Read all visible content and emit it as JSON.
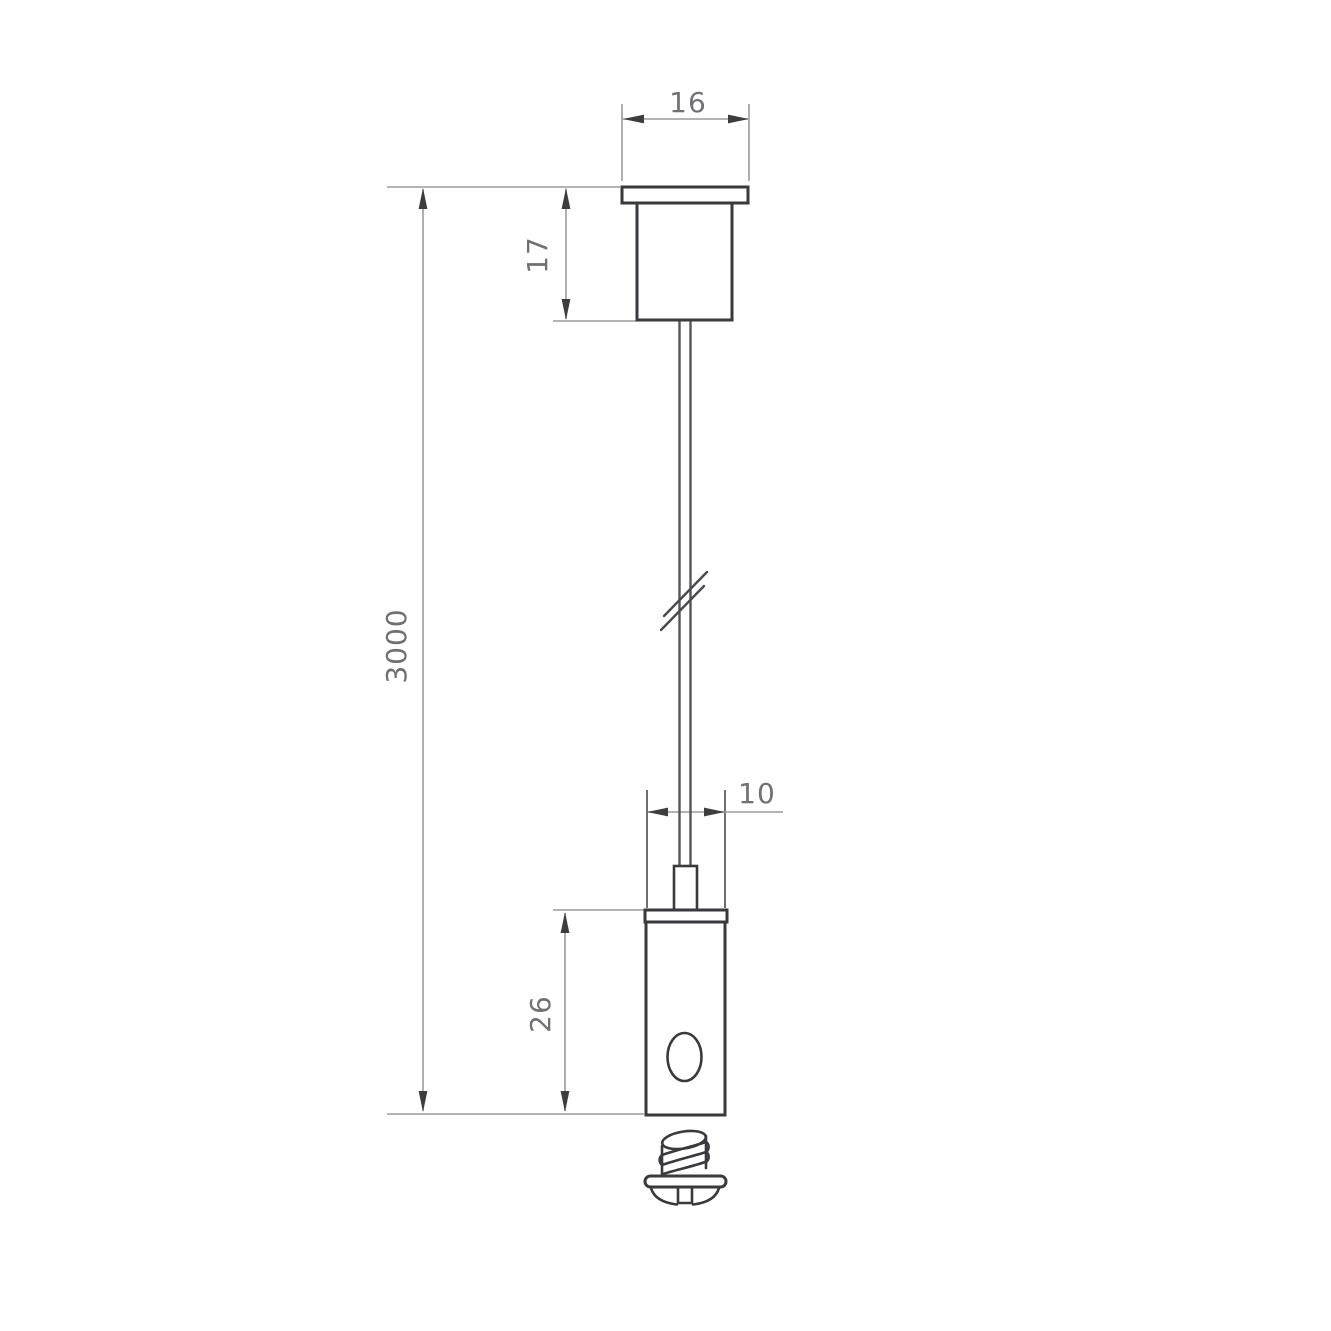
{
  "drawing": {
    "kind": "suspension-kit-dimensional-drawing",
    "labels": {
      "dim_16": "16",
      "dim_17": "17",
      "dim_3000": "3000",
      "dim_10": "10",
      "dim_26": "26"
    },
    "colors": {
      "background": "#ffffff",
      "object_line": "#3a3a3e",
      "dim_line": "#9b9b9b",
      "ext_line": "#6f6f73",
      "cable_line": "#55555a",
      "arrow": "#3d3d40",
      "text": "#717175"
    }
  }
}
